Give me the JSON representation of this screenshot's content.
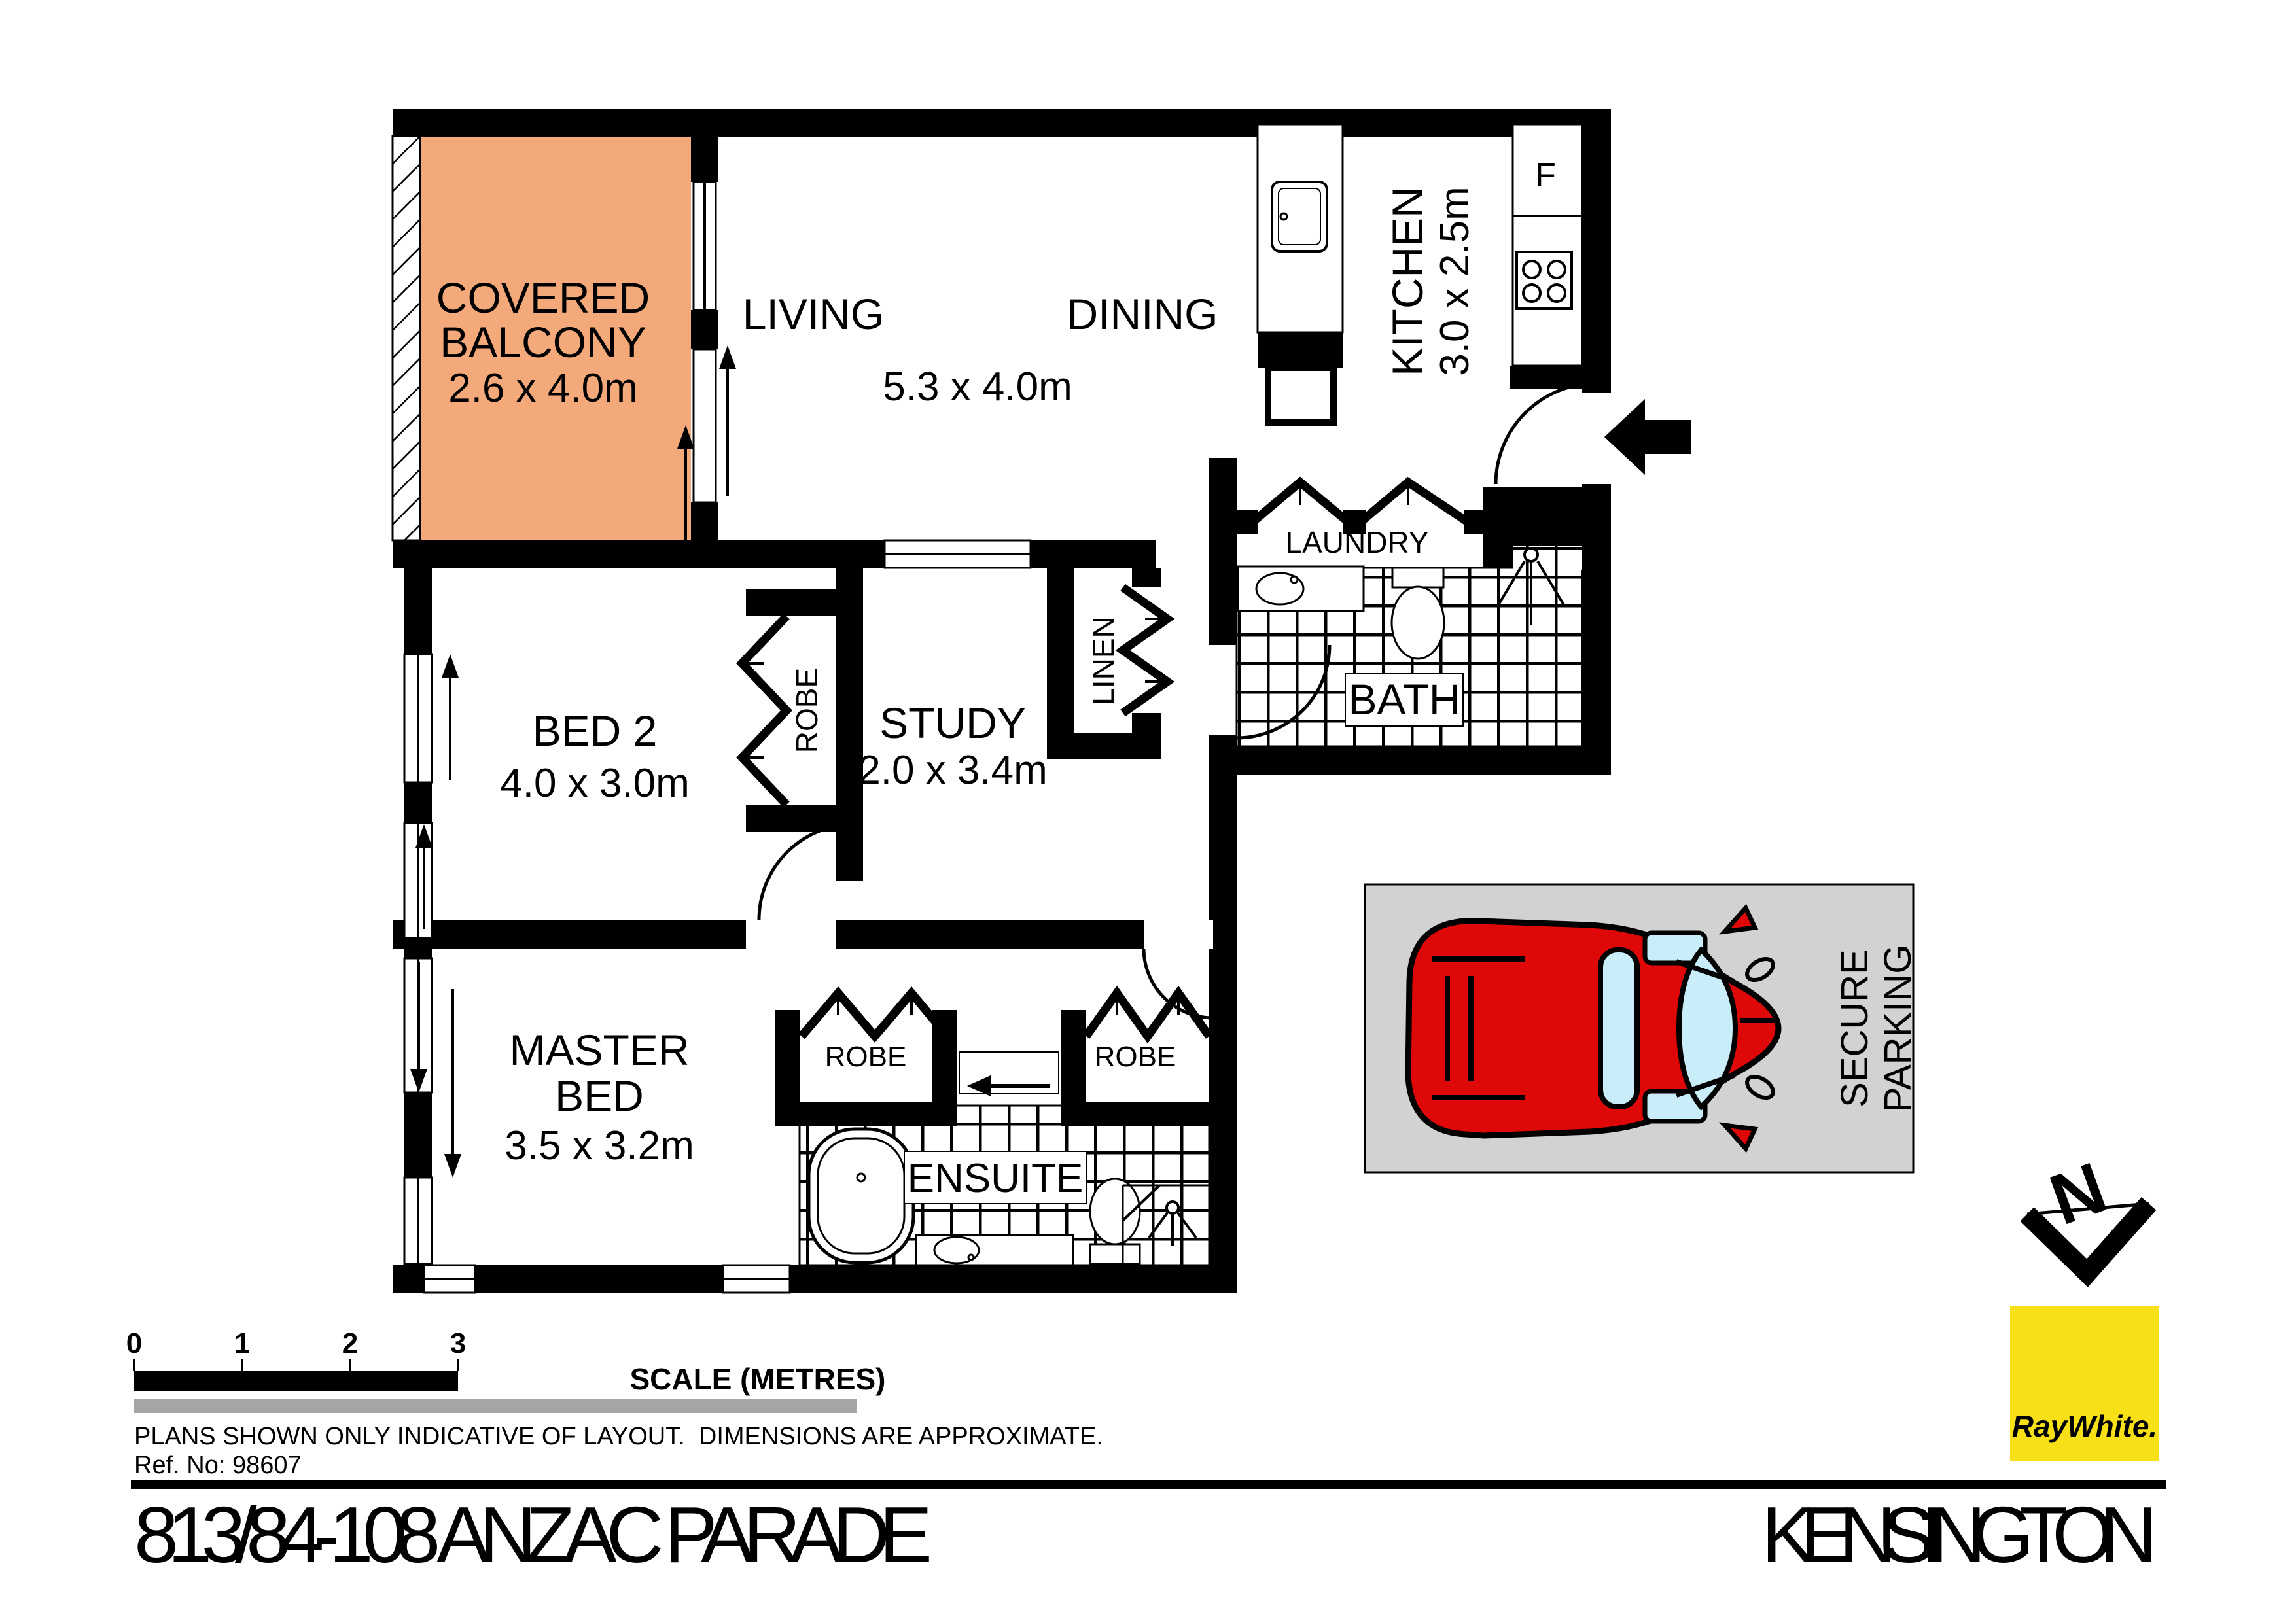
{
  "page": {
    "address": "813/84-108 ANZAC PARADE",
    "suburb": "KENSINGTON"
  },
  "plan": {
    "balcony": {
      "line1": "COVERED",
      "line2": "BALCONY",
      "dims": "2.6 x 4.0m"
    },
    "living": {
      "name": "LIVING"
    },
    "dining": {
      "name": "DINING"
    },
    "living_dining_dims": "5.3 x 4.0m",
    "kitchen": {
      "name": "KITCHEN",
      "dims": "3.0 x 2.5m",
      "fridge": "F"
    },
    "laundry": {
      "name": "LAUNDRY"
    },
    "bath": {
      "name": "BATH"
    },
    "linen": {
      "name": "LINEN"
    },
    "study": {
      "name": "STUDY",
      "dims": "2.0 x 3.4m"
    },
    "bed2": {
      "name": "BED 2",
      "dims": "4.0 x 3.0m"
    },
    "master": {
      "line1": "MASTER",
      "line2": "BED",
      "dims": "3.5 x 3.2m"
    },
    "ensuite": {
      "name": "ENSUITE"
    },
    "robe": "ROBE"
  },
  "parking": {
    "line1": "SECURE",
    "line2": "PARKING"
  },
  "compass": {
    "north": "N"
  },
  "scalebar": {
    "t0": "0",
    "t1": "1",
    "t2": "2",
    "t3": "3",
    "label": "SCALE (METRES)"
  },
  "notes": {
    "disclaimer": "PLANS SHOWN ONLY INDICATIVE OF LAYOUT.  DIMENSIONS ARE APPROXIMATE.",
    "ref": "Ref. No: 98607"
  },
  "brand": {
    "logo": "RayWhite."
  },
  "colors": {
    "balcony": "#F4A97B",
    "parking_bg": "#D2D2D2",
    "car_body": "#DD0807",
    "car_glass": "#C9EDF9",
    "brand_bg": "#F7E017",
    "brand_text": "#5E5E5C",
    "divider_gray": "#A5A5A5"
  }
}
